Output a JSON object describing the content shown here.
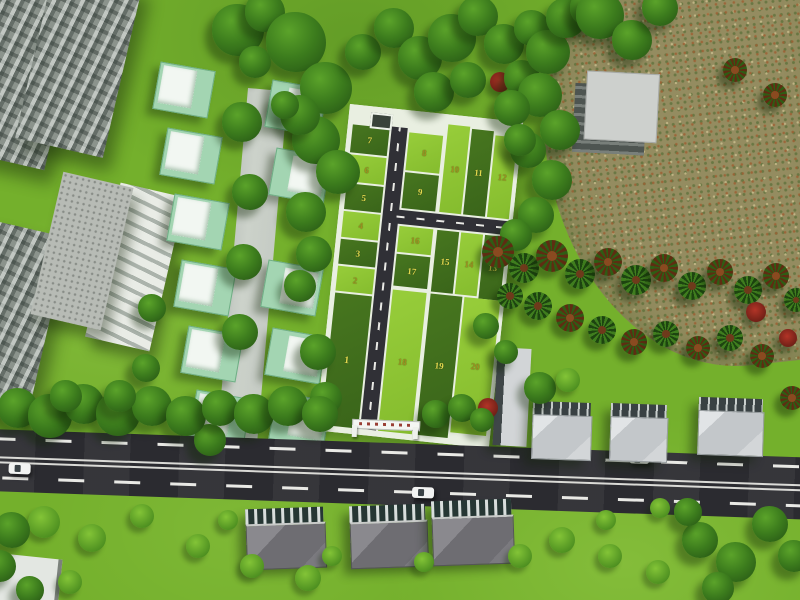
{
  "plots": {
    "p1": "1",
    "p2": "2",
    "p3": "3",
    "p4": "4",
    "p5": "5",
    "p6": "6",
    "p7": "7",
    "p8": "8",
    "p9": "9",
    "p10": "10",
    "p11": "11",
    "p12": "12",
    "p13": "13",
    "p14": "14",
    "p15": "15",
    "p16": "16",
    "p17": "17",
    "p18": "18",
    "p19": "19",
    "p20": "20"
  },
  "palette": {
    "grass": "#74b02c",
    "plot_dark_green": "#41701d",
    "plot_light_green": "#90c735",
    "boundary_white": "#e9efe1",
    "road_asphalt": "#2b2b30",
    "internal_road": "#303036",
    "road_marking": "#e9e9e5",
    "driveway_gray": "#ccd2ca",
    "field_brown": "#948c60",
    "villa_wall_green": "#a3d5b2",
    "villa_roof_white": "#f2f7f2",
    "tower_gray": "#8b938c",
    "number_on_dark": "#e2d84e",
    "number_on_light": "#a09121"
  }
}
